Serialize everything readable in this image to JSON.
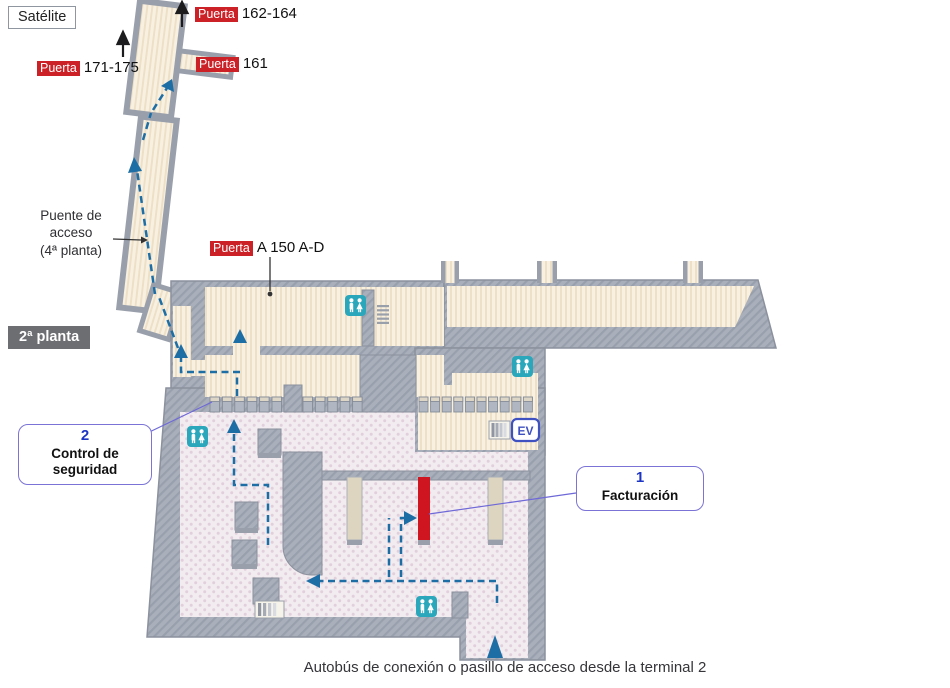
{
  "title_labels": {
    "satellite": "Satélite",
    "floor": "2ª planta",
    "caption": "Autobús de conexión o pasillo de acceso desde la terminal 2"
  },
  "gate_callouts": [
    {
      "badge": "Puerta",
      "text": "162-164"
    },
    {
      "badge": "Puerta",
      "text": "171-175"
    },
    {
      "badge": "Puerta",
      "text": "161"
    },
    {
      "badge": "Puerta",
      "text": "A 150 A-D"
    }
  ],
  "bridge_label": {
    "line1": "Puente de",
    "line2": "acceso",
    "line3": "(4ª planta)"
  },
  "numbered_callouts": [
    {
      "number": "1",
      "label": "Facturación"
    },
    {
      "number": "2",
      "label": "Control de seguridad"
    }
  ],
  "icons": {
    "elevator_label": "EV",
    "icon_names": [
      "restroom-icon",
      "elevator-icon",
      "escalator-icon",
      "stairs-icon",
      "security-gate",
      "check-in-desk",
      "route-arrow",
      "entry-arrow"
    ]
  },
  "colors": {
    "wall_hatch": "#aab0bb",
    "wall_line": "#8b919d",
    "floor_airside": "#f8f1e2",
    "floor_stripe": "#eee0c6",
    "floor_landside": "#f2ebef",
    "route_blue": "#1e6ea6",
    "restroom_teal": "#2ba7bc",
    "elevator_blue": "#3f51c1",
    "checkin_red": "#cf1520",
    "badge_red": "#cb2127",
    "badge_gray": "#6d6e71",
    "callout_border": "#7b74d6",
    "callout_number": "#1d35c4"
  }
}
